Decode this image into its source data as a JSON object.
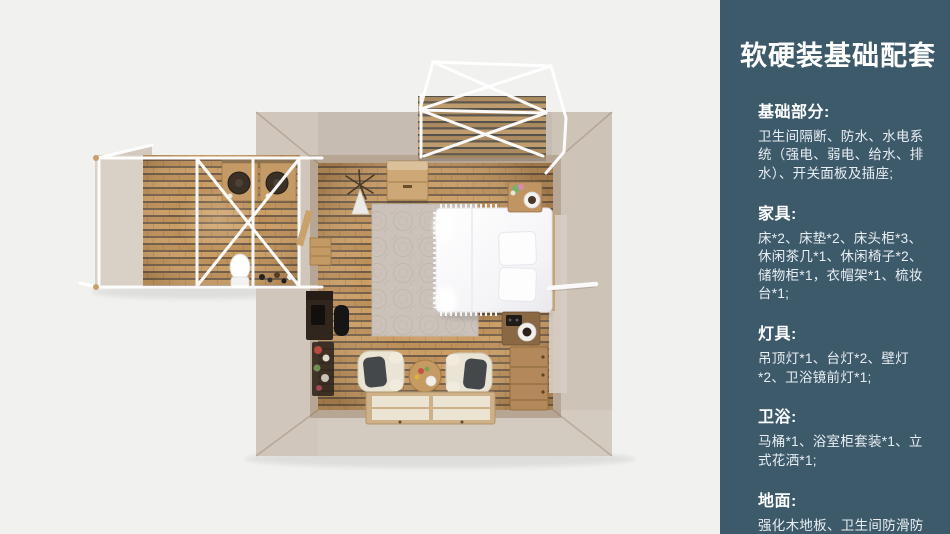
{
  "panel": {
    "title": "软硬装基础配套",
    "sections": [
      {
        "heading": "基础部分:",
        "body": "卫生间隔断、防水、水电系统（强电、弱电、给水、排水）、开关面板及插座;"
      },
      {
        "heading": "家具:",
        "body": "床*2、床垫*2、床头柜*3、休闲茶几*1、休闲椅子*2、储物柜*1，衣帽架*1、梳妆台*1;"
      },
      {
        "heading": "灯具:",
        "body": "吊顶灯*1、台灯*2、壁灯*2、卫浴镜前灯*1;"
      },
      {
        "heading": "卫浴:",
        "body": "马桶*1、浴室柜套装*1、立式花洒*1;"
      },
      {
        "heading": "地面:",
        "body": "强化木地板、卫生间防滑防潮石塑板;"
      }
    ]
  },
  "floorplan": {
    "caption": "顶视渲染图：主卧帐篷房（床、休闲椅、茶几、榻榻米、梳妆台、储物柜）与卫生间附属区（洗手盆*2、马桶）及木平台",
    "areas": [
      "main-room",
      "bathroom-annex",
      "entry-deck-annex"
    ]
  },
  "colors": {
    "panel_bg": "#3d5a6b",
    "panel_title": "#ffffff",
    "panel_text": "#e9eef2",
    "canvas_bg": "#f1f1f0",
    "wood": "#c2945c",
    "wall": "#cbc1b5",
    "frame": "#ffffff"
  }
}
